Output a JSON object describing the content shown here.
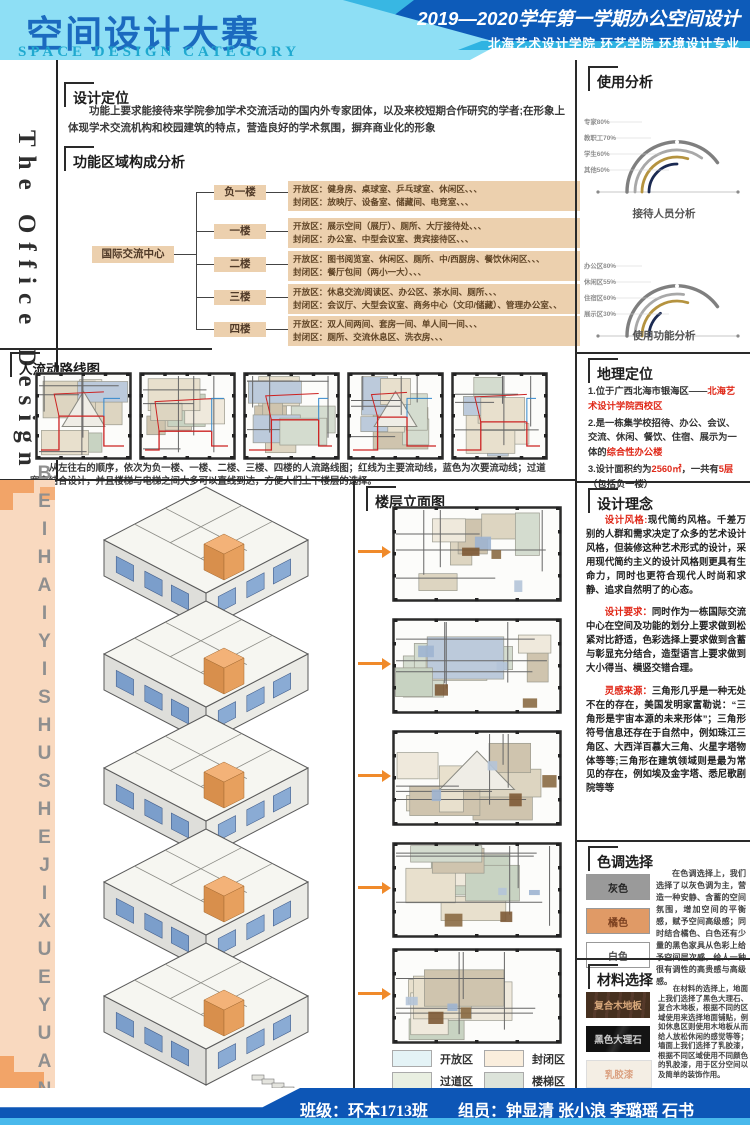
{
  "header": {
    "title_cn": "空间设计大赛",
    "title_en": "SPACE DESIGN CATEGORY",
    "right_line1": "2019—2020学年第一学期办公空间设计",
    "right_line2": "北海艺术设计学院 环艺学院 环境设计专业"
  },
  "left_column": {
    "vertical_title": "The Office Design"
  },
  "middle_strip": {
    "vertical_text": "BEIHAIYISHUSHEJIXUEYUAN"
  },
  "design_positioning": {
    "title": "设计定位",
    "body": "功能上要求能接待来学院参加学术交流活动的国内外专家团体，以及来校短期合作研究的学者;在形象上体现学术交流机构和校园建筑的特点，营造良好的学术氛围，摒弃商业化的形象"
  },
  "function_analysis": {
    "title": "功能区域构成分析",
    "root": "国际交流中心",
    "floors": [
      {
        "name": "负一楼",
        "open": "开放区：健身房、桌球室、乒乓球室、休闲区、、、",
        "closed": "封闭区：放映厅、设备室、储藏间、电竞室、、、"
      },
      {
        "name": "一楼",
        "open": "开放区：展示空间（展厅）、厕所、大厅接待处、、、",
        "closed": "封闭区：办公室、中型会议室、贵宾接待区、、、"
      },
      {
        "name": "二楼",
        "open": "开放区：图书阅览室、休闲区、厕所、中/西厨房、餐饮休闲区、、、",
        "closed": "封闭区：餐厅包间（两小一大）、、、"
      },
      {
        "name": "三楼",
        "open": "开放区：休息交流/阅读区、办公区、茶水间、厕所、、、",
        "closed": "封闭区：会议厅、大型会议室、商务中心（文印/储藏）、管理办公室、、"
      },
      {
        "name": "四楼",
        "open": "开放区：双人间两间、套房一间、单人间一间、、、",
        "closed": "封闭区：厕所、交流休息区、洗衣房、、、"
      }
    ]
  },
  "usage_analysis": {
    "title": "使用分析",
    "arc_colors": [
      "#7f7f7f",
      "#a8a8a8",
      "#b5933f",
      "#1b2a52"
    ],
    "charts": [
      {
        "caption": "接待人员分析",
        "labels": [
          "专家80%",
          "教职工70%",
          "学生60%",
          "其他50%"
        ],
        "values": [
          80,
          70,
          60,
          50
        ]
      },
      {
        "caption": "使用功能分析",
        "labels": [
          "办公区80%",
          "休闲区55%",
          "住宿区60%",
          "展示区30%"
        ],
        "values": [
          80,
          55,
          60,
          30
        ]
      }
    ]
  },
  "chart_data": [
    {
      "type": "arc-gauge",
      "title": "接待人员分析",
      "categories": [
        "专家",
        "教职工",
        "学生",
        "其他"
      ],
      "values": [
        80,
        70,
        60,
        50
      ],
      "unit": "%"
    },
    {
      "type": "arc-gauge",
      "title": "使用功能分析",
      "categories": [
        "办公区",
        "休闲区",
        "住宿区",
        "展示区"
      ],
      "values": [
        80,
        55,
        60,
        30
      ],
      "unit": "%"
    }
  ],
  "flow_map": {
    "title": "人流动路线图",
    "caption": "从左往右的顺序，依次为负一楼、一楼、二楼、三楼、四楼的人流路线图；红线为主要流动线，蓝色为次要流动线；过道宽窄结合设计，并且楼梯与电梯之间大多可以直线到达，方便人们上下楼层的选择。"
  },
  "floor_elevation": {
    "title": "楼层立面图"
  },
  "geo": {
    "title": "地理定位",
    "items": [
      {
        "runs": [
          {
            "text": "1.位于广西北海市银海区——"
          },
          {
            "text": "北海艺术设计学院西校区",
            "red": true
          }
        ]
      },
      {
        "runs": [
          {
            "text": "2.是一栋集学校招待、办公、会议、交流、休闲、餐饮、住宿、展示为一体的"
          },
          {
            "text": "综合性办公楼",
            "red": true
          }
        ]
      },
      {
        "runs": [
          {
            "text": "3.设计面积约为"
          },
          {
            "text": "2560㎡",
            "red": true
          },
          {
            "text": "，一共有"
          },
          {
            "text": "5层",
            "red": true
          },
          {
            "text": "（包括负一楼）"
          }
        ]
      }
    ]
  },
  "concept": {
    "title": "设计理念",
    "paragraphs": [
      {
        "lead": "设计风格:",
        "body": "现代简约风格。千差万别的人群和需求决定了众多的艺术设计风格，但装修这种艺术形式的设计，采用现代简约主义的设计风格则更具有生命力，同时也更符合现代人时尚和求静、追求自然明了的心态。"
      },
      {
        "lead": "设计要求：",
        "body": "同时作为一栋国际交流中心在空间及功能的划分上要求做到松紧对比舒适，色彩选择上要求做到含蓄与彰显充分结合，造型语言上要求做到大小得当、横竖交错合理。"
      },
      {
        "lead": "灵感来源：",
        "body": "三角形几乎是一种无处不在的存在，美国发明家富勒说：“三角形是宇宙本源的未来形体”；三角形符号信息还存在于自然中，例如珠江三角区、大西洋百慕大三角、火星字塔物体等等;三角形在建筑领域则是最为常见的存在，例如埃及金字塔、悉尼歌剧院等等"
      }
    ]
  },
  "palette": {
    "title": "色调选择",
    "swatches": [
      {
        "label": "灰色",
        "color": "#9a9a9a",
        "text_color": "#222222"
      },
      {
        "label": "橘色",
        "color": "#e09a66",
        "text_color": "#7a3f1f"
      },
      {
        "label": "白色",
        "color": "#ffffff",
        "text_color": "#555555"
      }
    ],
    "body": "在色调选择上，我们选择了以灰色调为主，营造一种安静、含蓄的空间氛围，增加空间的平衡感，赋予空间高级感；同时结合橘色、白色还有少量的黑色家具从色彩上给予空间层次感，给人一种很有调性的高贵感与高级感。"
  },
  "materials": {
    "title": "材料选择",
    "swatches": [
      {
        "label": "复合木地板",
        "color": "#46301f"
      },
      {
        "label": "黑色大理石",
        "color": "#1a1a1a"
      },
      {
        "label": "乳胶漆",
        "color": "#f4eee4"
      }
    ],
    "body": "在材料的选择上，地面上我们选择了黑色大理石、复合木地板，根据不同的区域使用来选择地面铺贴，例如休息区则使用木地板从而给人放松休闲的感觉等等；墙面上我们选择了乳胶漆，根据不同区域使用不同颜色的乳胶漆，用于区分空间以及简单的装饰作用。"
  },
  "legend": {
    "items": [
      {
        "label": "开放区",
        "color": "#e4f3f6"
      },
      {
        "label": "封闭区",
        "color": "#faeedd"
      },
      {
        "label": "过道区",
        "color": "#e9efe1"
      },
      {
        "label": "楼梯区",
        "color": "#dce3da"
      }
    ]
  },
  "footer": {
    "class_label": "班级：环本1713班",
    "members_label": "组员：钟显清 张小浪 李璐瑶 石书"
  },
  "colors": {
    "header_blue": "#0d5bb9",
    "header_light": "#8edff5",
    "tan_box": "#ecd0ae",
    "accent_orange": "#f08a2a",
    "red_text": "#e02818"
  }
}
